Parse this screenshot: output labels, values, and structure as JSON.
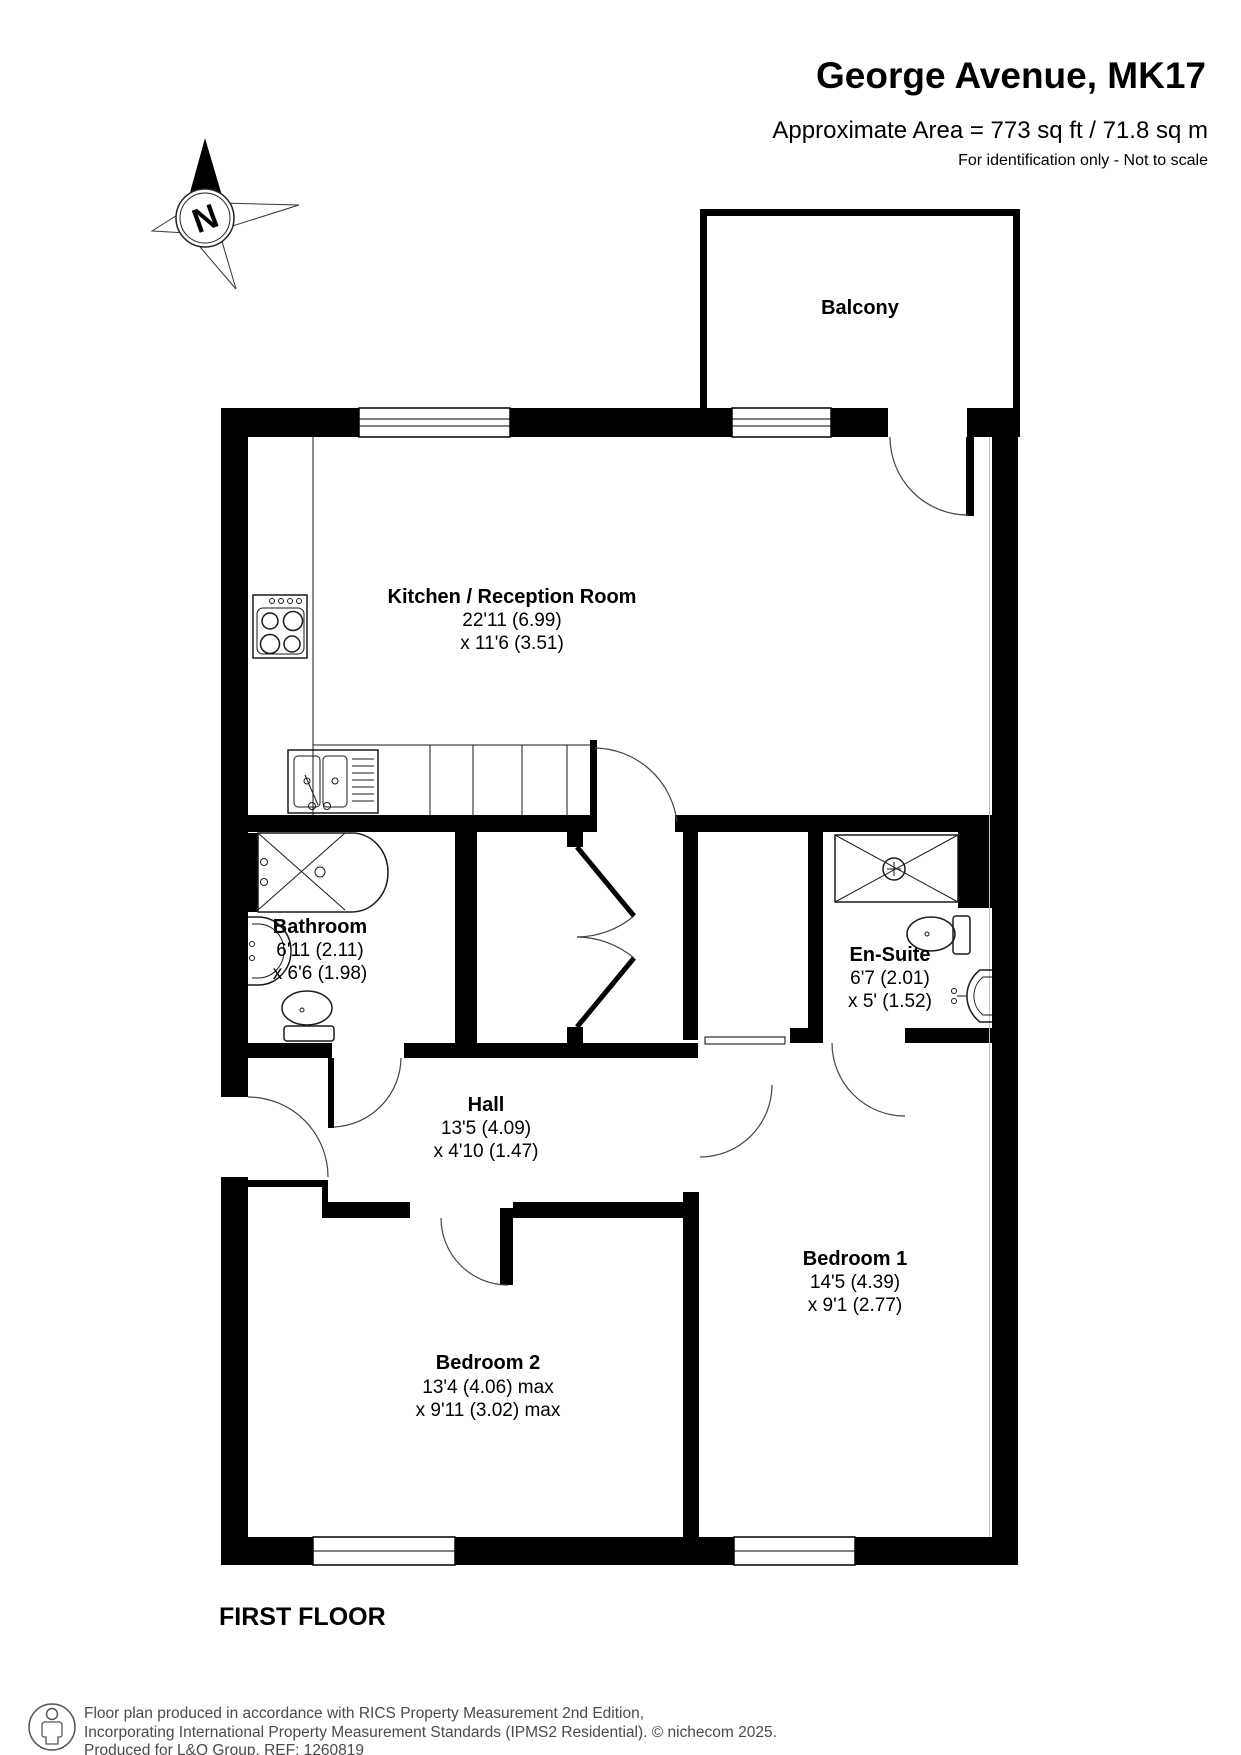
{
  "header": {
    "title": "George Avenue, MK17",
    "area": "Approximate Area = 773 sq ft / 71.8 sq m",
    "note": "For identification only - Not to scale"
  },
  "compass": {
    "label": "N"
  },
  "rooms": {
    "balcony": {
      "name": "Balcony"
    },
    "kitchen": {
      "name": "Kitchen / Reception Room",
      "dim1": "22'11 (6.99)",
      "dim2": "x 11'6 (3.51)"
    },
    "bathroom": {
      "name": "Bathroom",
      "dim1": "6'11 (2.11)",
      "dim2": "x 6'6 (1.98)"
    },
    "ensuite": {
      "name": "En-Suite",
      "dim1": "6'7 (2.01)",
      "dim2": "x 5' (1.52)"
    },
    "hall": {
      "name": "Hall",
      "dim1": "13'5 (4.09)",
      "dim2": "x 4'10 (1.47)"
    },
    "bedroom1": {
      "name": "Bedroom 1",
      "dim1": "14'5 (4.39)",
      "dim2": "x 9'1 (2.77)"
    },
    "bedroom2": {
      "name": "Bedroom 2",
      "dim1": "13'4 (4.06) max",
      "dim2": "x 9'11 (3.02) max"
    }
  },
  "floor_label": "FIRST FLOOR",
  "footer": {
    "line1": "Floor plan produced in accordance with RICS Property Measurement 2nd Edition,",
    "line2": "Incorporating International Property Measurement Standards (IPMS2 Residential).   © nichecom 2025.",
    "line3": "Produced for L&Q Group.   REF:    1260819"
  },
  "icons": {
    "compass": "compass-rose-icon",
    "logo": "person-icon"
  },
  "colors": {
    "wall": "#000000",
    "background": "#ffffff",
    "footer_text": "#4a4a4a"
  }
}
